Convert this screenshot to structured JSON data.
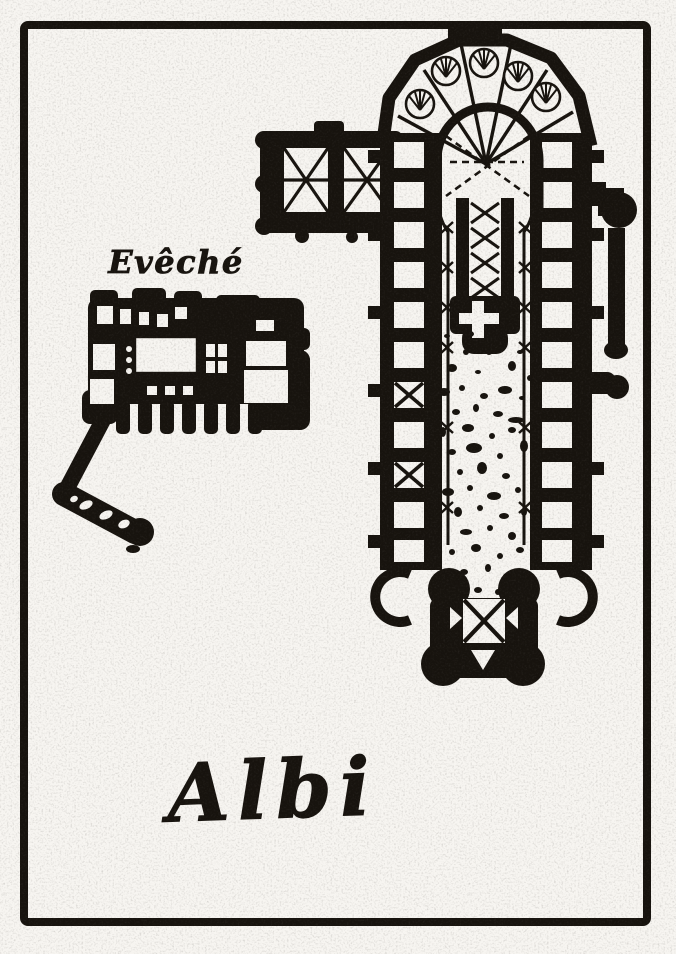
{
  "figure": {
    "labels": {
      "palace": "Evêché",
      "city": "Albi"
    },
    "colors": {
      "ink": "#17130e",
      "paper": "#f7f5f1"
    }
  }
}
